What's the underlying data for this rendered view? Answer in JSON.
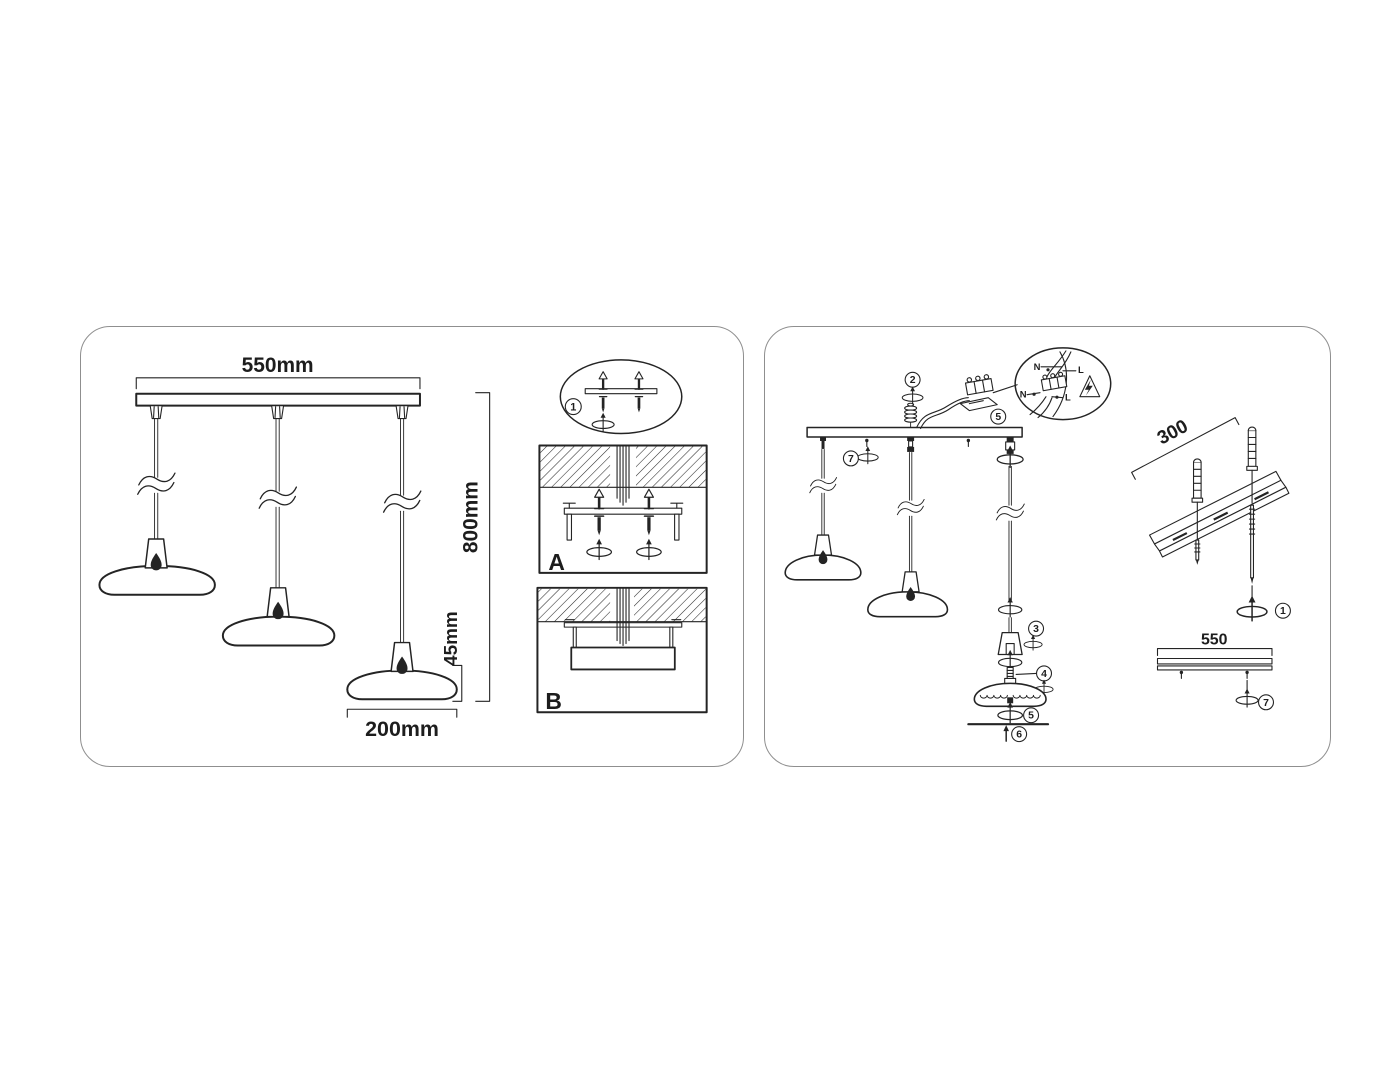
{
  "colors": {
    "line": "#242424",
    "panel_border": "#8f8f8f",
    "background": "#ffffff"
  },
  "left": {
    "dim_top": "550mm",
    "dim_height": "800mm",
    "dim_shade_h": "45mm",
    "dim_shade_w": "200mm",
    "step1": "1",
    "label_a": "A",
    "label_b": "B"
  },
  "right": {
    "step2": "2",
    "step5": "5",
    "step7": "7",
    "step3": "3",
    "step4": "4",
    "step5b": "5",
    "step6": "6",
    "step1": "1",
    "step7b": "7",
    "n1": "N",
    "l1": "L",
    "n2": "N",
    "l2": "L",
    "rail_dim": "300",
    "bar_dim": "550"
  }
}
